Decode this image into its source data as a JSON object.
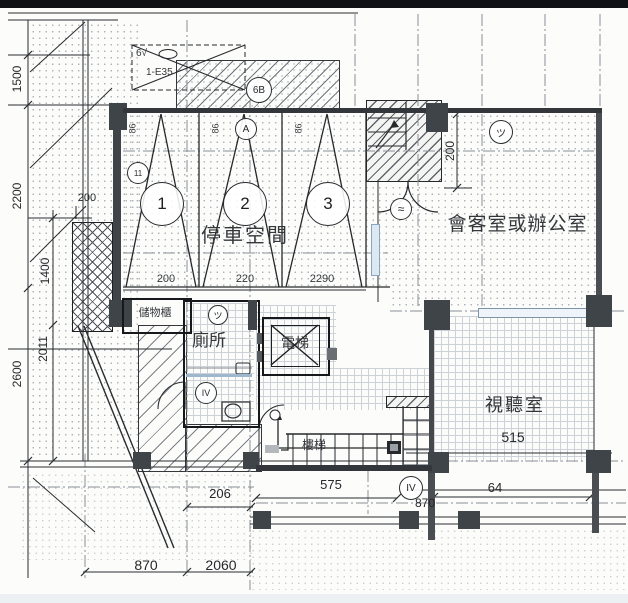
{
  "drawing": {
    "rooms": {
      "parking": {
        "label": "停車空間",
        "bay_label": "86",
        "stalls": [
          "1",
          "2",
          "3"
        ],
        "stall_widths": [
          "200",
          "220",
          "2290"
        ]
      },
      "reception": {
        "label": "會客室或辦公室"
      },
      "av_room": {
        "label": "視聽室",
        "area_label": "515"
      },
      "toilet": {
        "label": "廁所"
      },
      "elevator": {
        "label": "電梯"
      },
      "storage": {
        "label": "儲物櫃"
      },
      "stairs": {
        "label": "樓梯"
      }
    },
    "dimensions": {
      "left_outer": [
        "1500",
        "2200",
        "2600"
      ],
      "left_inner": [
        "1400",
        "2011"
      ],
      "left_small": "200",
      "top_right": "200",
      "bottom_mid": [
        "206",
        "575",
        "870",
        "64"
      ],
      "bottom_left": [
        "870",
        "2060"
      ]
    },
    "markers": {
      "left": "11",
      "section": "A",
      "wall": "6B",
      "storage": "ツ",
      "reception": "ツ",
      "entry": "≈",
      "toilet": "IV",
      "grid": "IV"
    },
    "annotation_box": {
      "line1": "6√",
      "line2": "1-E35"
    },
    "colors": {
      "wall": "#3f4449",
      "line": "#2a2d30",
      "window_blue": "#8aa5bc",
      "hatch": "#6f747a"
    }
  }
}
